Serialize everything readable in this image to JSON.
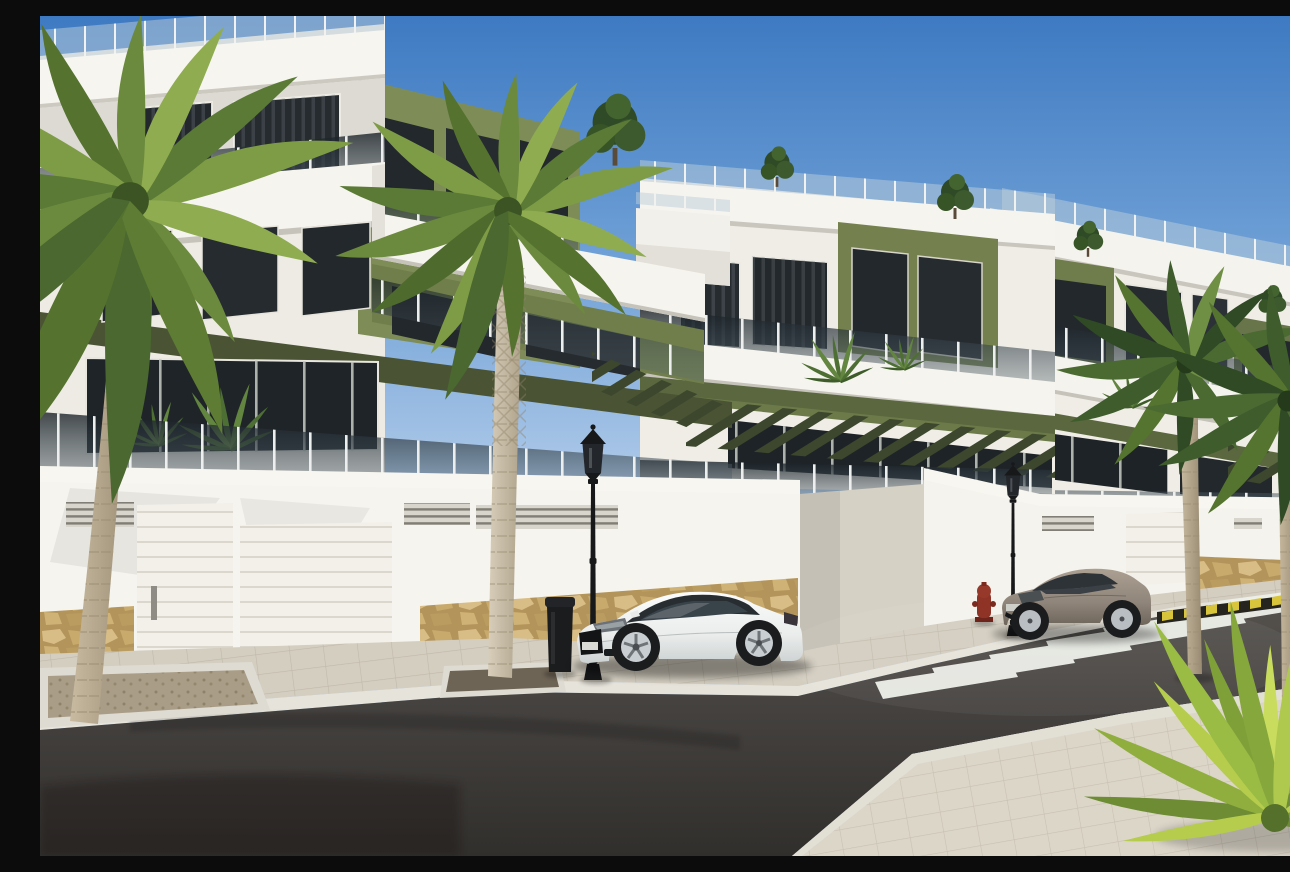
{
  "image": {
    "width_px": 1290,
    "height_px": 840,
    "kind": "3D exterior architectural render of a new-build residential street"
  },
  "palette": {
    "sky_top": "#3E7AC2",
    "sky_horizon": "#CEE0F2",
    "wall_white": "#F6F4EE",
    "wall_shaded": "#D8D6CF",
    "accent_olive": "#7E8C57",
    "accent_olive_dark": "#4A5434",
    "pergola_slat": "#3C472D",
    "glazing_dark": "#23282C",
    "balustrade_glass": "#2A343B",
    "stone_tan": "#C5A368",
    "sidewalk_paver": "#D3CDC0",
    "road_asphalt": "#45423E",
    "crosswalk_white": "#EEF0EA",
    "warning_yellow": "#D8C53C",
    "warning_black": "#26241F",
    "car_white": "#F4F5F4",
    "car_beige": "#9C9184",
    "lamp_black": "#17181A",
    "hydrant_red": "#8E3326",
    "palm_green_dark": "#3E5A28",
    "palm_green_light": "#8FAC50",
    "palm_trunk": "#BFB29A"
  },
  "scene": {
    "sky": {
      "label": "clear blue sky"
    },
    "buildings": {
      "label": "terraced apartment blocks in white and olive green",
      "blocks": [
        {
          "label": "left block, three storeys with glass balconies"
        },
        {
          "label": "middle block with slatted pergola terraces"
        },
        {
          "label": "right block stepping down the hill"
        }
      ],
      "features": [
        "rooftop glass railings",
        "smoked-glass balustrades",
        "olive-green accent walls",
        "slatted pergolas",
        "dark tinted glazing",
        "white perimeter wall",
        "sectional garage doors",
        "ventilation grilles",
        "rubble-stone wall base",
        "roof-terrace shrubs",
        "balcony plants"
      ]
    },
    "street": {
      "label": "asphalt road with paved sidewalks",
      "crosswalk": {
        "label": "zebra crossing",
        "stripe_count": 7
      },
      "warning_curb": {
        "label": "yellow and black striped kerb"
      },
      "planters": 2,
      "driveway": {
        "label": "ramped driveway between wall sections"
      }
    },
    "vehicles": [
      {
        "label": "white sports coupe parked at the kerb",
        "body_color": "#F4F5F4"
      },
      {
        "label": "beige coupe parked before the crossing",
        "body_color": "#9C9184"
      }
    ],
    "street_furniture": {
      "street_lamps": {
        "label": "classic black lantern street lamp",
        "count": 3
      },
      "litter_bin": {
        "label": "black litter bin",
        "count": 1
      },
      "fire_hydrant": {
        "label": "red fire hydrant",
        "count": 1
      }
    },
    "vegetation": {
      "palm_trees": {
        "label": "tall palm trees",
        "count": 4
      },
      "palm_shrub": {
        "label": "young palm shrub at the corner",
        "count": 1
      },
      "rooftop_shrubs": {
        "count": 5
      },
      "balcony_plants": {
        "count": 4
      }
    }
  }
}
